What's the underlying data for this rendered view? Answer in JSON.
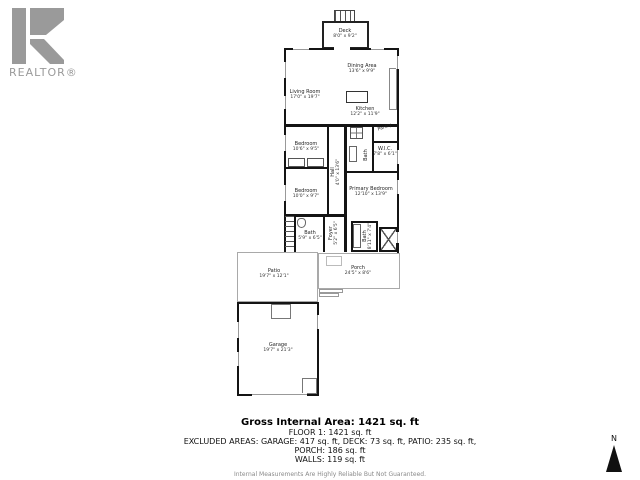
{
  "brand": {
    "name": "REALTOR®"
  },
  "compass": {
    "label": "N"
  },
  "rooms": {
    "deck": {
      "label": "Deck",
      "dims": "8'0\" x 9'2\""
    },
    "living": {
      "label": "Living Room",
      "dims": "17'0\" x 19'7\""
    },
    "dining": {
      "label": "Dining Area",
      "dims": "13'6\" x 9'9\""
    },
    "kitchen": {
      "label": "Kitchen",
      "dims": "12'2\" x 11'9\""
    },
    "pantry": {
      "label": "Pantry",
      "dims": ""
    },
    "bedroom1": {
      "label": "Bedroom",
      "dims": "10'6\" x 9'5\""
    },
    "bedroom2": {
      "label": "Bedroom",
      "dims": "10'0\" x 9'7\""
    },
    "hall": {
      "label": "Hall",
      "dims": "4'0\" x 13'6\""
    },
    "bath1": {
      "label": "Bath",
      "dims": ""
    },
    "wic": {
      "label": "W.I.C.",
      "dims": "7'8\" x 6'1\""
    },
    "primary": {
      "label": "Primary Bedroom",
      "dims": "12'10\" x 13'9\""
    },
    "bath2": {
      "label": "Bath",
      "dims": "5'9\" x 6'5\""
    },
    "foyer": {
      "label": "Foyer",
      "dims": "5'2\" x 6'5\""
    },
    "bath3": {
      "label": "Bath",
      "dims": "8'11\" x 7'4\""
    },
    "porch": {
      "label": "Porch",
      "dims": "24'5\" x 8'6\""
    },
    "patio": {
      "label": "Patio",
      "dims": "19'7\" x 12'1\""
    },
    "garage": {
      "label": "Garage",
      "dims": "19'7\" x 21'3\""
    }
  },
  "summary": {
    "title": "Gross Internal Area: 1421 sq. ft",
    "lines": [
      "FLOOR 1: 1421 sq. ft",
      "EXCLUDED AREAS: GARAGE: 417 sq. ft, DECK: 73 sq. ft, PATIO: 235 sq. ft,",
      "PORCH: 186 sq. ft",
      "WALLS: 119 sq. ft"
    ],
    "disclaimer": "Internal Measurements Are Highly Reliable But Not Guaranteed."
  },
  "colors": {
    "wall": "#141414",
    "light_outline": "#a9a9a9",
    "logo_gray": "#9a9a9a"
  }
}
